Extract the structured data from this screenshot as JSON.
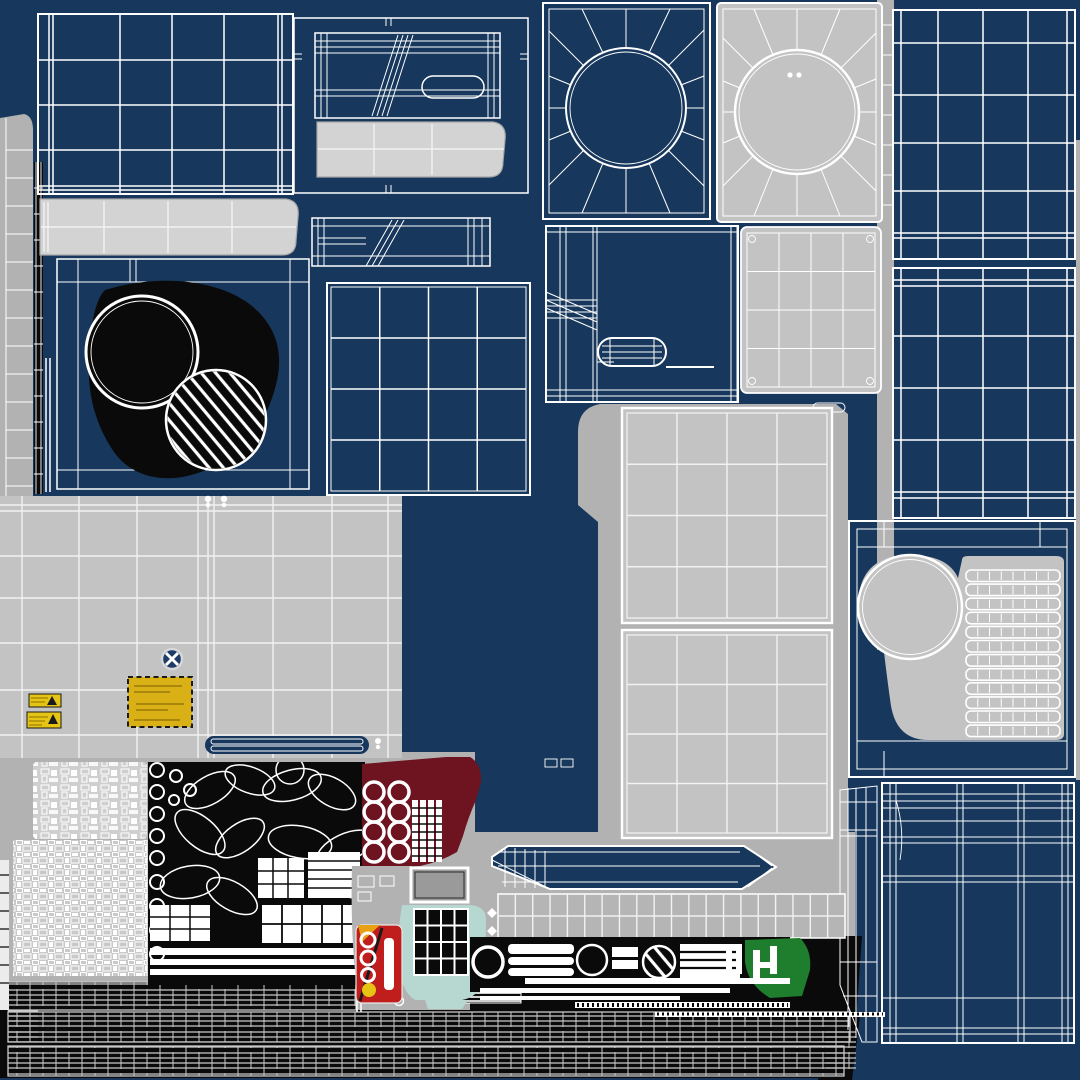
{
  "meta": {
    "type": "uv-texture-atlas",
    "subject": "3d-model wireframe texture layout, appliance panels",
    "canvas_w": 1080,
    "canvas_h": 1080
  },
  "palette": {
    "navy": "#17375C",
    "wire": "#FFFFFF",
    "gray": "#C3C3C3",
    "gray_light": "#D3D3D3",
    "gray_backdrop": "#B2B2B2",
    "gray_grid": "#F2F2F2",
    "gray_mid": "#9A9A9A",
    "black": "#0A0A0A",
    "maroon": "#6E1421",
    "teal": "#B7D8D1",
    "green": "#1F7E2E",
    "yellow_label": "#D9B117",
    "yellow_warning": "#E6C414",
    "red": "#C01D1D",
    "orange": "#E8A015",
    "badge": "#1D3C68",
    "mesh_line": "#C9C9C9"
  },
  "details": {
    "fan_spokes": 16,
    "maroon_rings": {
      "rows": 4,
      "cols": 2
    },
    "louver_vent": {
      "rows": 12,
      "cols": 8
    },
    "ground_mesh_bands": 3,
    "ladder_strip_rungs": 12,
    "black_grid_panel": {
      "rows": 4,
      "cols": 4
    }
  },
  "regions": [
    {
      "id": "top-left-grid-panel",
      "kind": "navy wireframe plaid grid"
    },
    {
      "id": "top-left-gray-bar",
      "kind": "light gray segmented bar"
    },
    {
      "id": "door-panel-black-blob",
      "kind": "navy panel, black blob, plain ring circle + hatched circle"
    },
    {
      "id": "left-ladder-strip",
      "kind": "gray strip with rungs + black thin strip"
    },
    {
      "id": "mid-top-framed-panel",
      "kind": "wireframe panel with capsule + gray bar"
    },
    {
      "id": "mid-thin-rail",
      "kind": "thin wireframe rail"
    },
    {
      "id": "mid-grid-square",
      "kind": "navy wireframe 4x4 grid"
    },
    {
      "id": "fan-panel-blue",
      "kind": "radial fan grille wireframe"
    },
    {
      "id": "fan-panel-gray",
      "kind": "radial fan grille gray filled"
    },
    {
      "id": "gray-grid-small-panel",
      "kind": "gray 4x4 grid with corner screws"
    },
    {
      "id": "capsule-panel",
      "kind": "navy panel with capsule handle"
    },
    {
      "id": "right-column-grid-upper",
      "kind": "navy plaid grid"
    },
    {
      "id": "right-column-grid-lower",
      "kind": "navy plaid grid"
    },
    {
      "id": "louver-side-panel",
      "kind": "gray blob, big circle intake, 12-row louver vent"
    },
    {
      "id": "bottom-right-plaid-panel",
      "kind": "dense navy plaid wireframe"
    },
    {
      "id": "middle-gray-panel-upper",
      "kind": "gray 4x4 grid panel"
    },
    {
      "id": "middle-gray-panel-lower",
      "kind": "gray 4x4 grid panel"
    },
    {
      "id": "left-big-gray-panel",
      "kind": "gray grid panel with warning labels"
    },
    {
      "id": "no-step-badge",
      "kind": "navy circle with white X"
    },
    {
      "id": "yellow-spec-label",
      "kind": "mustard label, dashed border"
    },
    {
      "id": "warning-sticker-1",
      "kind": "small yellow warning label"
    },
    {
      "id": "warning-sticker-2",
      "kind": "small yellow warning label"
    },
    {
      "id": "pcb-island-upper",
      "kind": "dense white micro-parts on gray"
    },
    {
      "id": "pcb-island-lower",
      "kind": "dense white micro-parts on gray"
    },
    {
      "id": "black-parts-cluster",
      "kind": "fan blades, rings, grille blocks on black"
    },
    {
      "id": "maroon-island",
      "kind": "8 white rings + film strips on maroon"
    },
    {
      "id": "teal-island",
      "kind": "teal blob with black 4x4 grid"
    },
    {
      "id": "extinguisher-label",
      "kind": "red label, white rings, yellow dot"
    },
    {
      "id": "display-window",
      "kind": "gray rect, thick white outline"
    },
    {
      "id": "arrow-panel",
      "kind": "navy arrow-shaped wireframe"
    },
    {
      "id": "gray-grid-strip",
      "kind": "20x2 gray grid strip"
    },
    {
      "id": "control-strip",
      "kind": "black strip: rings, hatched circle, bars, green patch"
    },
    {
      "id": "ground-mesh-band-1",
      "kind": "hose/ground dense mesh"
    },
    {
      "id": "ground-mesh-band-2",
      "kind": "hose/ground dense mesh"
    },
    {
      "id": "ground-mesh-band-3",
      "kind": "hose/ground dense mesh"
    }
  ]
}
